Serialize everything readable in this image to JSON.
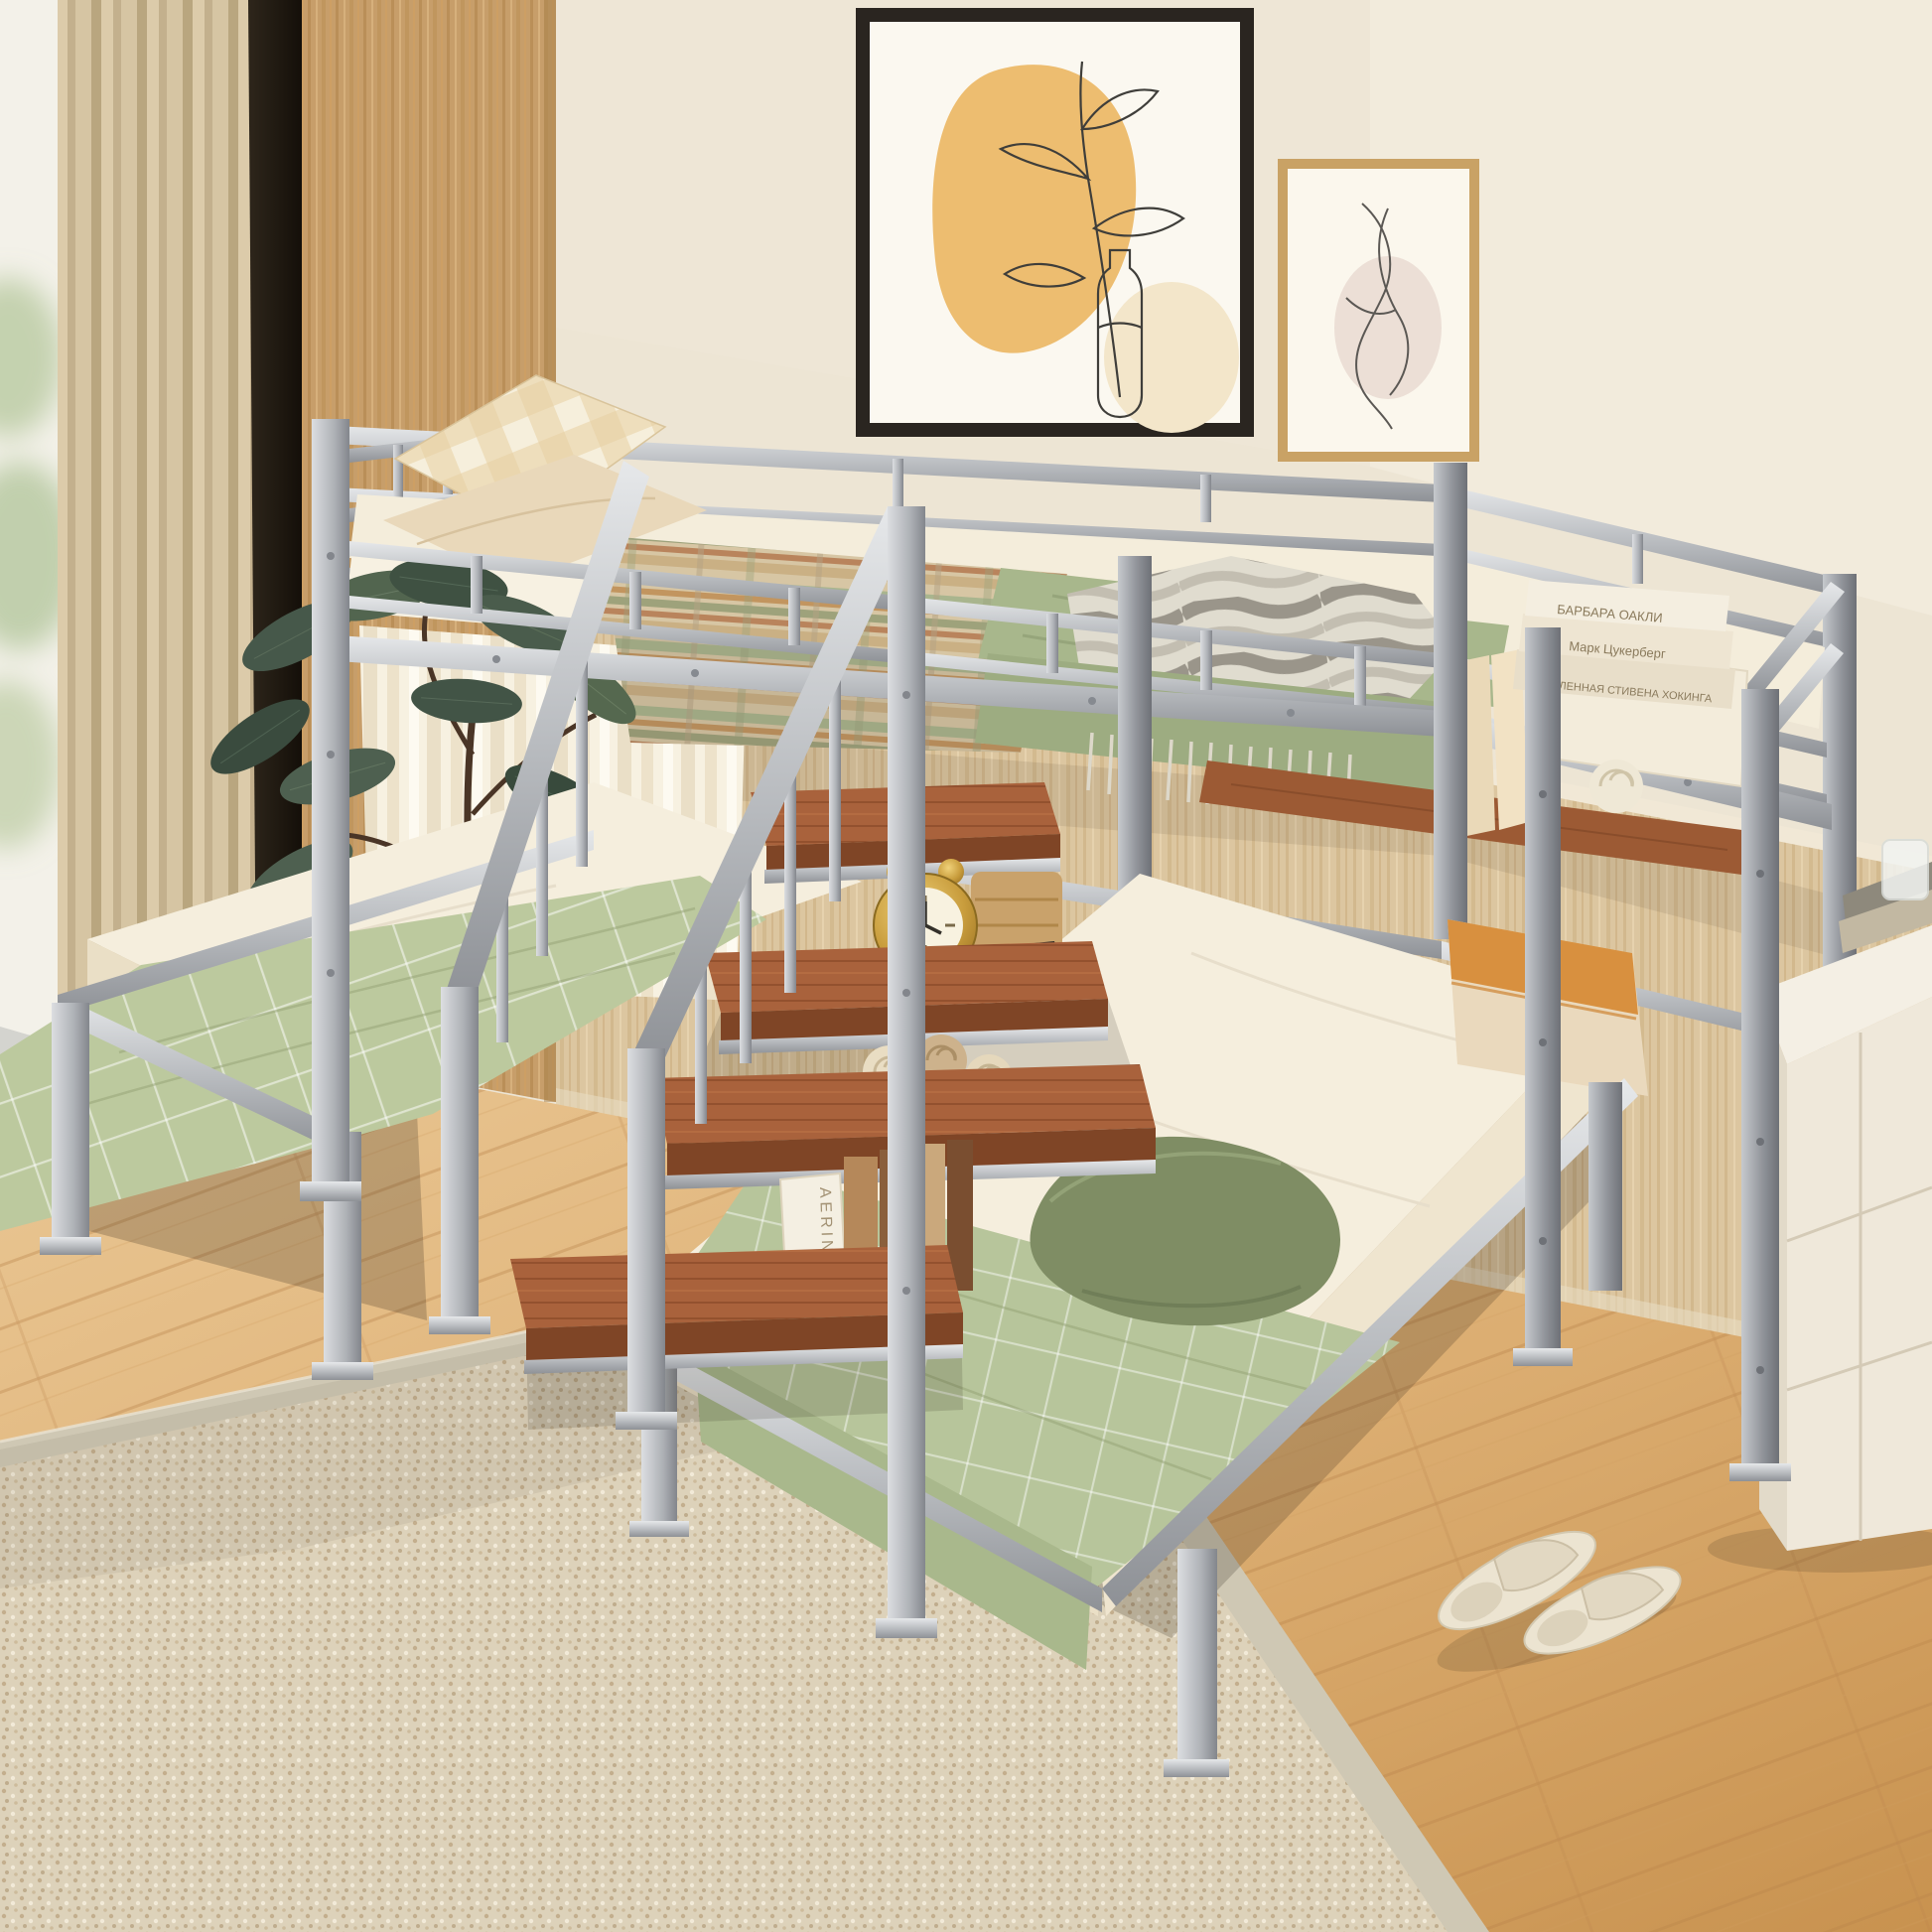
{
  "scene": {
    "type": "product-photo",
    "subject": "Silver metal triple bunk bed (twin over two twins) with storage staircase, in a beige bedroom",
    "palette": {
      "metal_silver": "#b6b9bd",
      "metal_dark": "#8e9196",
      "step_wood": "#a9623c",
      "wall_cream": "#ede5d4",
      "wainscot_wood": "#dcc6a0",
      "floor_oak": "#dcae72",
      "curtain_beige": "#cdbc9c",
      "panel_tan": "#c79e6a",
      "rug_beige": "#ddd2ba",
      "blanket_green": "#b7c59b",
      "duvet_green": "#a8b78c",
      "pillow_olive": "#7f8d64",
      "pillow_orange": "#d8903f",
      "bedding_cream": "#f5eedd",
      "clock_gold": "#c89c3c",
      "art_accent_orange": "#ecb968"
    }
  },
  "books": {
    "stack_spine_1": "БАРБАРА ОАКЛИ",
    "stack_spine_2": "Марк Цукерберг",
    "stack_spine_3": "ВСЕЛЕННАЯ СТИВЕНА ХОКИНГА",
    "shelf_spine_vertical": "AERIN"
  }
}
